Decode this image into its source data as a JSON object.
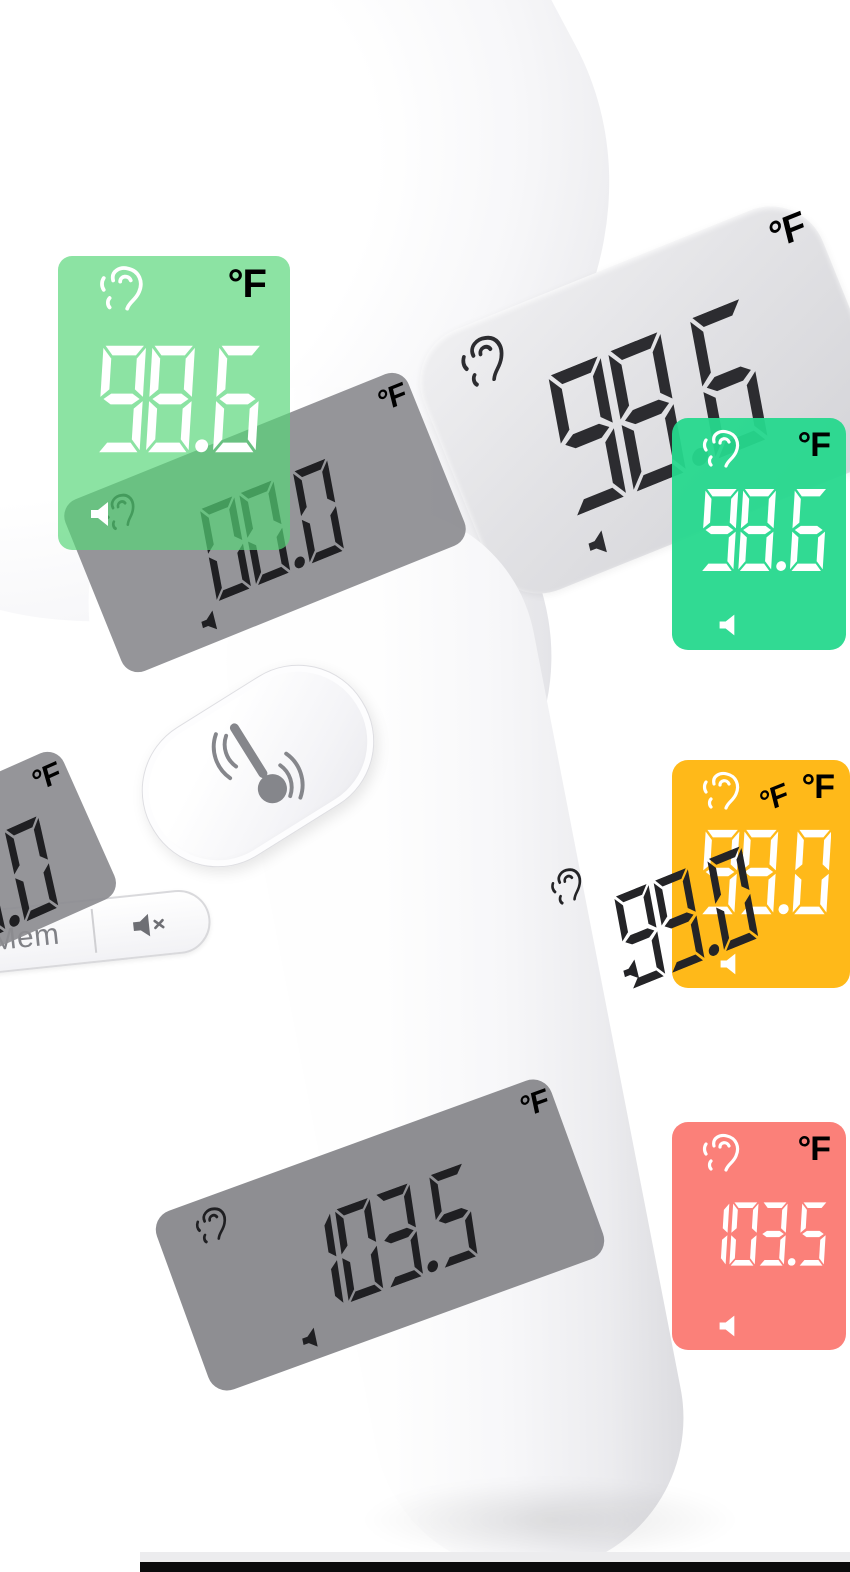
{
  "image": {
    "subject": "white non-contact forehead thermometer product photo"
  },
  "device": {
    "screen_reading": {
      "value": "98.6",
      "unit": "°F"
    },
    "buttons": {
      "memory_label": "Mem"
    }
  },
  "panels": [
    {
      "id": "device-screen",
      "value": "98.6",
      "unit": "°F",
      "fg": "#2c2c30",
      "bg": ""
    },
    {
      "id": "gray-snapshot-left",
      "value": "00.0",
      "unit": "°F",
      "fg": "#1f1f22",
      "bg": "rgba(140,140,144,0.92)"
    },
    {
      "id": "gray-snapshot-top",
      "value": "00.0",
      "unit": "°F",
      "fg": "#1f1f22",
      "bg": "rgba(140,140,144,0.92)"
    },
    {
      "id": "green-left",
      "value": "98.6",
      "unit": "°F",
      "fg": "#ffffff",
      "bg": "rgba(86,214,120,0.68)"
    },
    {
      "id": "green-right",
      "value": "98.6",
      "unit": "°F",
      "fg": "#ffffff",
      "bg": "rgba(38,216,141,0.95)"
    },
    {
      "id": "gray-snapshot-middle",
      "value": "99.0",
      "unit": "°F",
      "fg": "#242427",
      "bg": "rgba(146,146,150,0.92)"
    },
    {
      "id": "orange",
      "value": "99.0",
      "unit": "°F",
      "fg": "#ffffff",
      "bg": "rgba(255,177,0,0.90)"
    },
    {
      "id": "gray-snapshot-bottom",
      "value": "103.5",
      "unit": "°F",
      "fg": "#1f1f22",
      "bg": "rgba(136,136,140,0.95)"
    },
    {
      "id": "red",
      "value": "103.5",
      "unit": "°F",
      "fg": "#ffffff",
      "bg": "rgba(250,110,102,0.88)"
    }
  ],
  "icons": {
    "ear": "ear-icon",
    "speaker": "speaker-icon",
    "mute": "mute-speaker-icon",
    "thermometer": "thermometer-scan-icon"
  },
  "colors": {
    "green_light": "#8CE3A3",
    "green": "#31D991",
    "orange": "#FFB41A",
    "red": "#F97E77",
    "gray_overlay": "#949497",
    "lcd_dark": "#2c2c30",
    "probe_cap": "#060606",
    "bottom_bar": "#0b0b0c"
  }
}
